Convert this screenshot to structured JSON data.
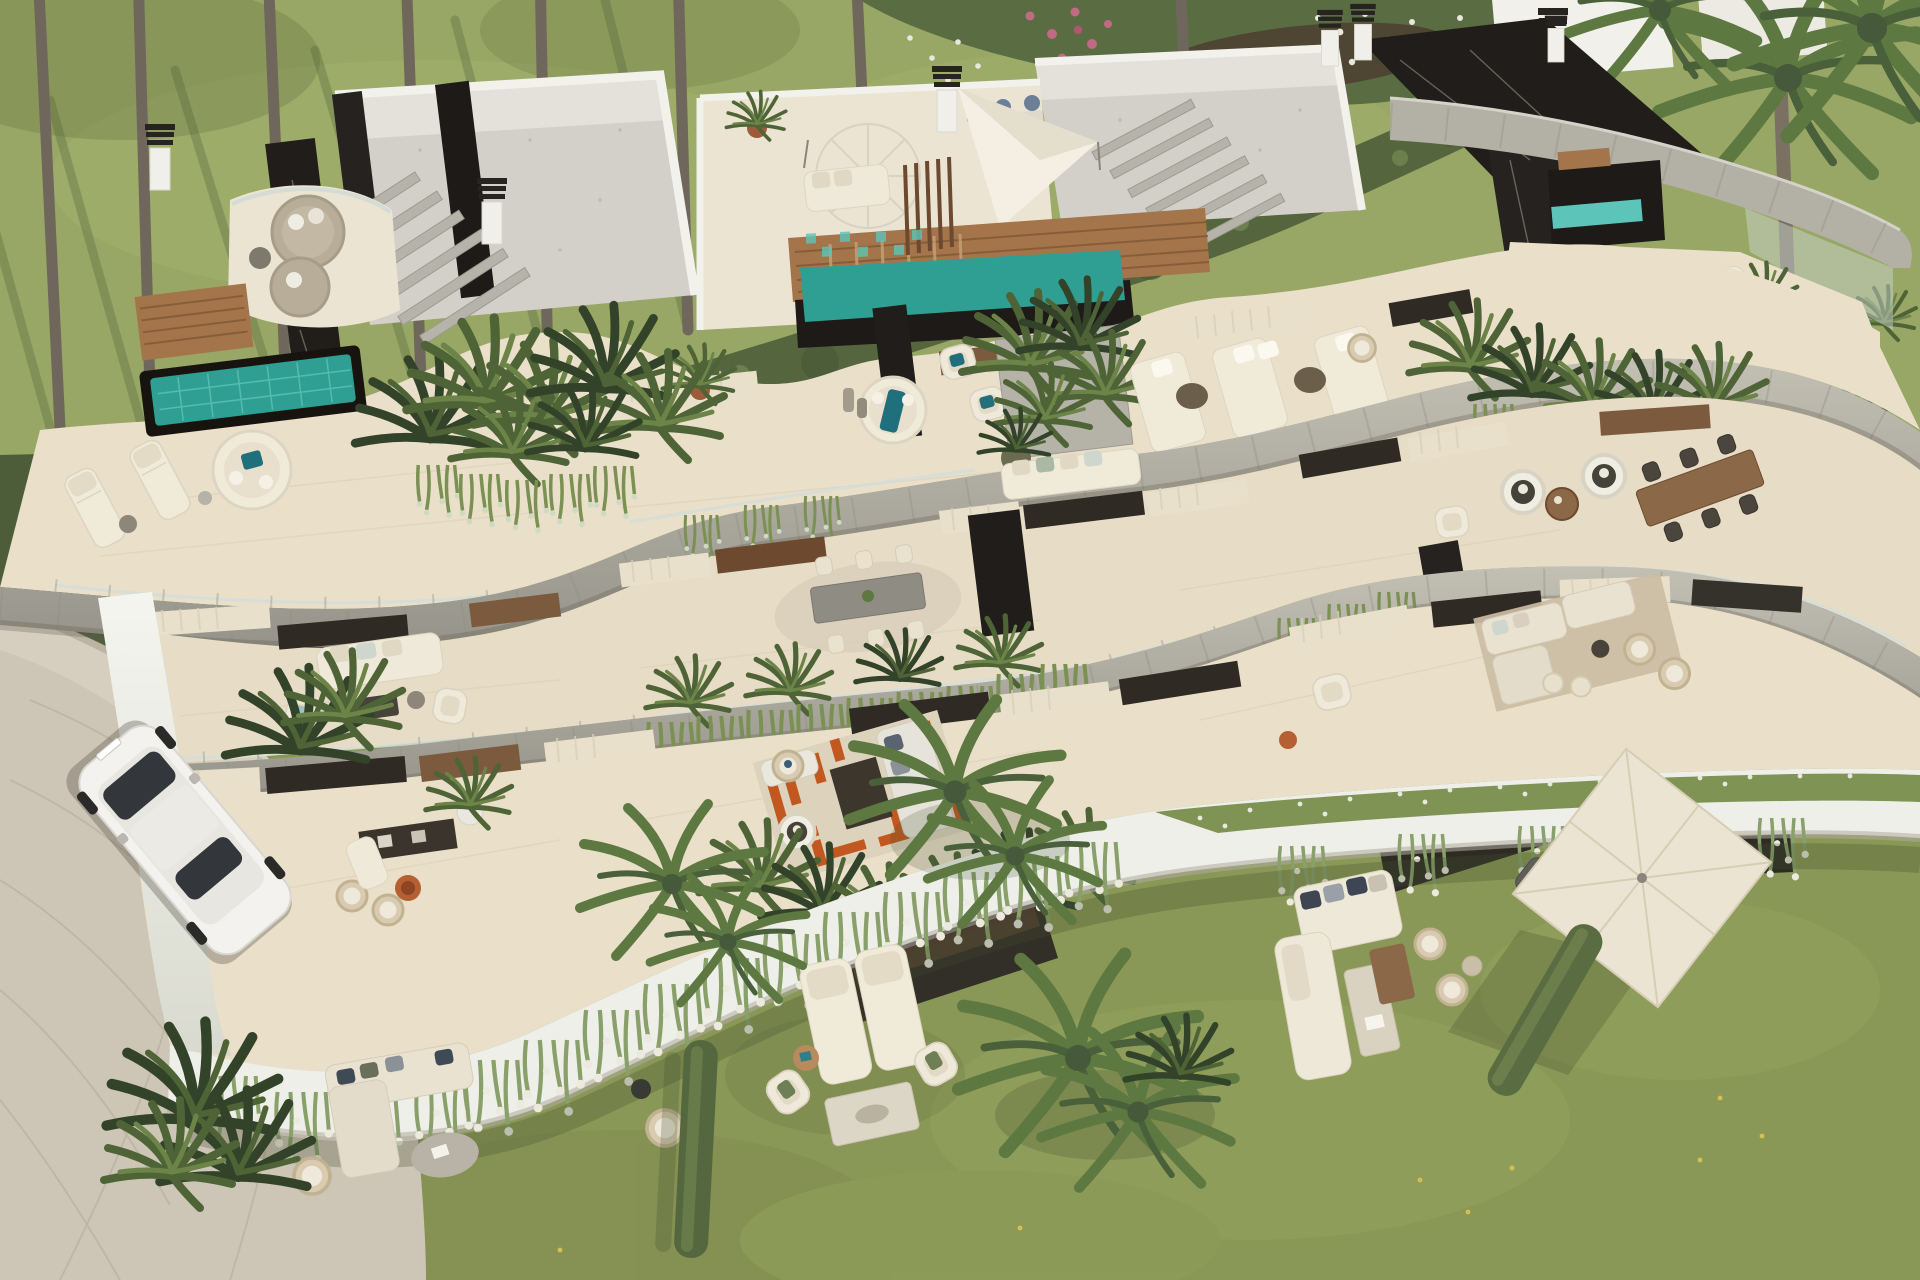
{
  "meta": {
    "title": "Aerial 3D render of a curved luxury apartment building with terraced gardens",
    "view": "high-angle aerial",
    "style": "architectural visualization",
    "lighting": "midday sun from upper right"
  },
  "palette": {
    "lawn": "#8a9857",
    "lawnTop": "#98a765",
    "lawnShade": "#6e7d49",
    "hedge": "#55663e",
    "leafDark": "#3f5233",
    "leaf": "#5d7840",
    "ivy": "#7b9154",
    "terrace": "#eadfc9",
    "terraceMid": "#e7dcc6",
    "stone": "#b0ada1",
    "stoneDark": "#8f8d83",
    "whiteBand": "#edefe8",
    "marble": "#201d1a",
    "wood": "#a4744b",
    "woodDark": "#6d4a2f",
    "pool": "#2f9f93",
    "poolTile": "#5cc4b8",
    "gravel": "#d3d0c9",
    "driveway": "#cdc5b6",
    "glass": "#cfdad6",
    "curtain": "#e8e0cb",
    "windowDark": "#2f2a24",
    "canvas": "#ece4d2",
    "cushionTeal": "#1f6f7c",
    "rugOrange": "#c2581f",
    "rugCream": "#ddd3bd",
    "soil": "#4c3f2f",
    "flowerPink": "#c06a83",
    "flowerWhite": "#e9e7de",
    "carBody": "#f3f2ee"
  },
  "scene": {
    "environment": {
      "top_lawn": "manicured lawn with palm trunks and long clipped hedge",
      "flower_bed": "white and pink flower border behind the hedge",
      "right_slope": "grass slope with tall palm along right edge",
      "garden": "large lawn wrapping the lower building",
      "driveway": "cobbled driveway at lower left with curved white wall"
    },
    "building": {
      "form": "organic curved slab building with stacked cantilevered terraces",
      "levels": [
        "rooftop penthouses",
        "penthouse terraces",
        "mid-level terraces",
        "garden level"
      ],
      "materials": [
        "white stucco",
        "travertine stone bands",
        "black marquina marble",
        "teak decking",
        "glass balustrades"
      ],
      "rooftop_features": [
        "gravel flat roofs",
        "black marble chimney volumes",
        "stone pergolas",
        "white shade sails",
        "white parasol",
        "teak stair deck",
        "turquoise plunge pools",
        "round daybeds",
        "outdoor dining for six"
      ],
      "terrace_features": [
        "sun loungers",
        "round daybed with teal cushion",
        "planter boxes with ferns",
        "grey al-fresco dining table for six",
        "hanging egg chairs",
        "teak dining table",
        "white modular sofas",
        "orange geometric rug lounge",
        "TV sideboard",
        "cascading ivy and white-flowering vines"
      ]
    },
    "garden_furniture": {
      "left_group": [
        "L-shaped cream sectional sofa",
        "wicker armchair",
        "organic stone coffee table"
      ],
      "center_group": [
        "two cream sun loungers",
        "two armchairs with green cushions",
        "rectangular coffee table with tray",
        "round timber side table",
        "wicker chair"
      ],
      "right_group": [
        "square cream parasol",
        "grey sun lounger",
        "white daybed with cushions",
        "white sofa",
        "bench with book",
        "teak coffee table",
        "two wicker chairs"
      ]
    },
    "vehicle": {
      "type": "white SUV",
      "location": "parked on the driveway"
    },
    "vegetation": {
      "palm_trunks_top": 8,
      "foreground_palms": 6,
      "hedges": [
        "long clipped hedge behind building",
        "two freestanding hedge strips in lawn"
      ],
      "cascading_plants": "ivy and white-flowering vines over terrace edges"
    }
  }
}
